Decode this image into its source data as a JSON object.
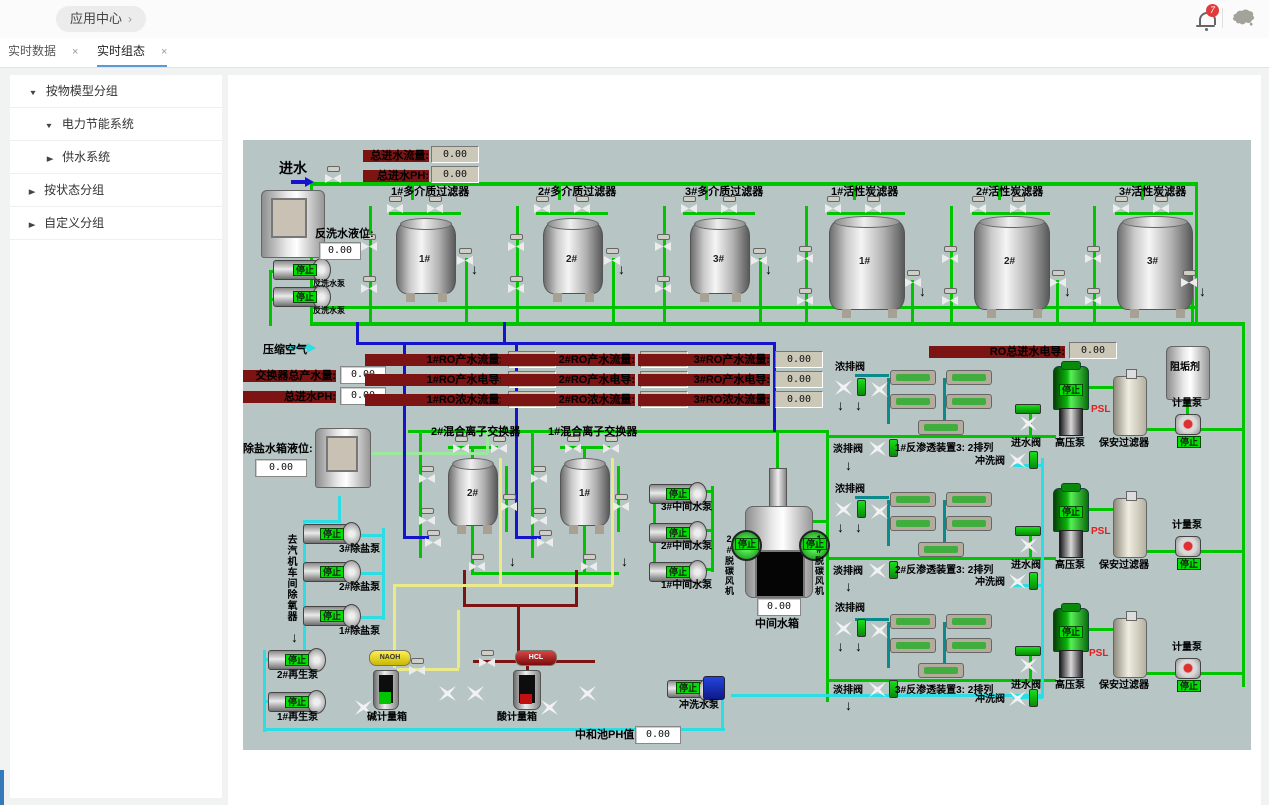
{
  "header": {
    "breadcrumb": "应用中心",
    "chevron": "›",
    "badge": "7"
  },
  "tabs": [
    {
      "label": "实时数据",
      "close": "×"
    },
    {
      "label": "实时组态",
      "close": "×"
    }
  ],
  "sidebar": {
    "items": [
      {
        "label": "按物模型分组",
        "arrow": "▼"
      },
      {
        "label": "电力节能系统",
        "arrow": "▼"
      },
      {
        "label": "供水系统",
        "arrow": "▶"
      },
      {
        "label": "按状态分组",
        "arrow": "▶"
      },
      {
        "label": "自定义分组",
        "arrow": "▶"
      }
    ]
  },
  "scada": {
    "inlet": "进水",
    "compressed_air": "压缩空气",
    "stop": "停止",
    "psl": "PSL",
    "down_arrow": "↓",
    "right_arrow": "→",
    "fields": {
      "total_flow": {
        "label": "总进水流量:",
        "value": "0.00"
      },
      "total_ph": {
        "label": "总进水PH:",
        "value": "0.00"
      },
      "backwash_level": {
        "label": "反洗水液位:",
        "value": "0.00"
      },
      "exchanger_total": {
        "label": "交换器总产水量:",
        "value": "0.00"
      },
      "inlet_ph2": {
        "label": "总进水PH:",
        "value": "0.00"
      },
      "ro1_flow": {
        "label": "1#RO产水流量:",
        "value": "0.00"
      },
      "ro1_cond": {
        "label": "1#RO产水电导:",
        "value": "0.00"
      },
      "ro1_conc": {
        "label": "1#RO浓水流量:",
        "value": "0.00"
      },
      "ro2_flow": {
        "label": "2#RO产水流量:",
        "value": "0.00"
      },
      "ro2_cond": {
        "label": "2#RO产水电导:",
        "value": "0.00"
      },
      "ro2_conc": {
        "label": "2#RO浓水流量:",
        "value": "0.00"
      },
      "ro3_flow": {
        "label": "3#RO产水流量:",
        "value": "0.00"
      },
      "ro3_cond": {
        "label": "3#RO产水电导:",
        "value": "0.00"
      },
      "ro3_conc": {
        "label": "3#RO浓水流量:",
        "value": "0.00"
      },
      "ro_total_cond": {
        "label": "RO总进水电导:",
        "value": "0.00"
      },
      "desal_level": {
        "label": "除盐水箱液位:",
        "value": "0.00"
      },
      "mid_tank_level": {
        "value": "0.00"
      },
      "neutral_ph": {
        "label": "中和池PH值:",
        "value": "0.00"
      }
    },
    "filters": [
      "1#多介质过滤器",
      "2#多介质过滤器",
      "3#多介质过滤器",
      "1#活性炭滤器",
      "2#活性炭滤器",
      "3#活性炭滤器"
    ],
    "tank_nums": [
      "1#",
      "2#",
      "3#",
      "1#",
      "2#",
      "3#"
    ],
    "exchangers": [
      "2#混合离子交换器",
      "1#混合离子交换器"
    ],
    "exchanger_nums": [
      "2#",
      "1#"
    ],
    "backwash_pump": "反洗水泵",
    "desal_pumps": [
      "3#除盐泵",
      "2#除盐泵",
      "1#除盐泵"
    ],
    "mid_pumps": [
      "3#中间水泵",
      "2#中间水泵",
      "1#中间水泵"
    ],
    "regen_pumps": [
      "2#再生泵",
      "1#再生泵"
    ],
    "flush_pump": "冲洗水泵",
    "fans": [
      "2#脱碳风机",
      "1#脱碳风机"
    ],
    "mid_tank": "中间水箱",
    "ro_units": [
      "1#反渗透装置3: 2排列",
      "2#反渗透装置3: 2排列",
      "3#反渗透装置3: 2排列"
    ],
    "valve_labels": {
      "conc": "浓排阀",
      "fresh": "淡排阀",
      "rinse": "冲洗阀",
      "inlet": "进水阀"
    },
    "hp_pump": "高压泵",
    "guard_filter": "保安过滤器",
    "meter_pump": "计量泵",
    "chems": {
      "naoh": "NAOH",
      "hcl": "HCL",
      "alkali_tank": "碱计量箱",
      "acid_tank": "酸计量箱",
      "scale_inhibitor": "阻垢剂"
    },
    "to_deaerator": "去汽机车间除氧器"
  }
}
